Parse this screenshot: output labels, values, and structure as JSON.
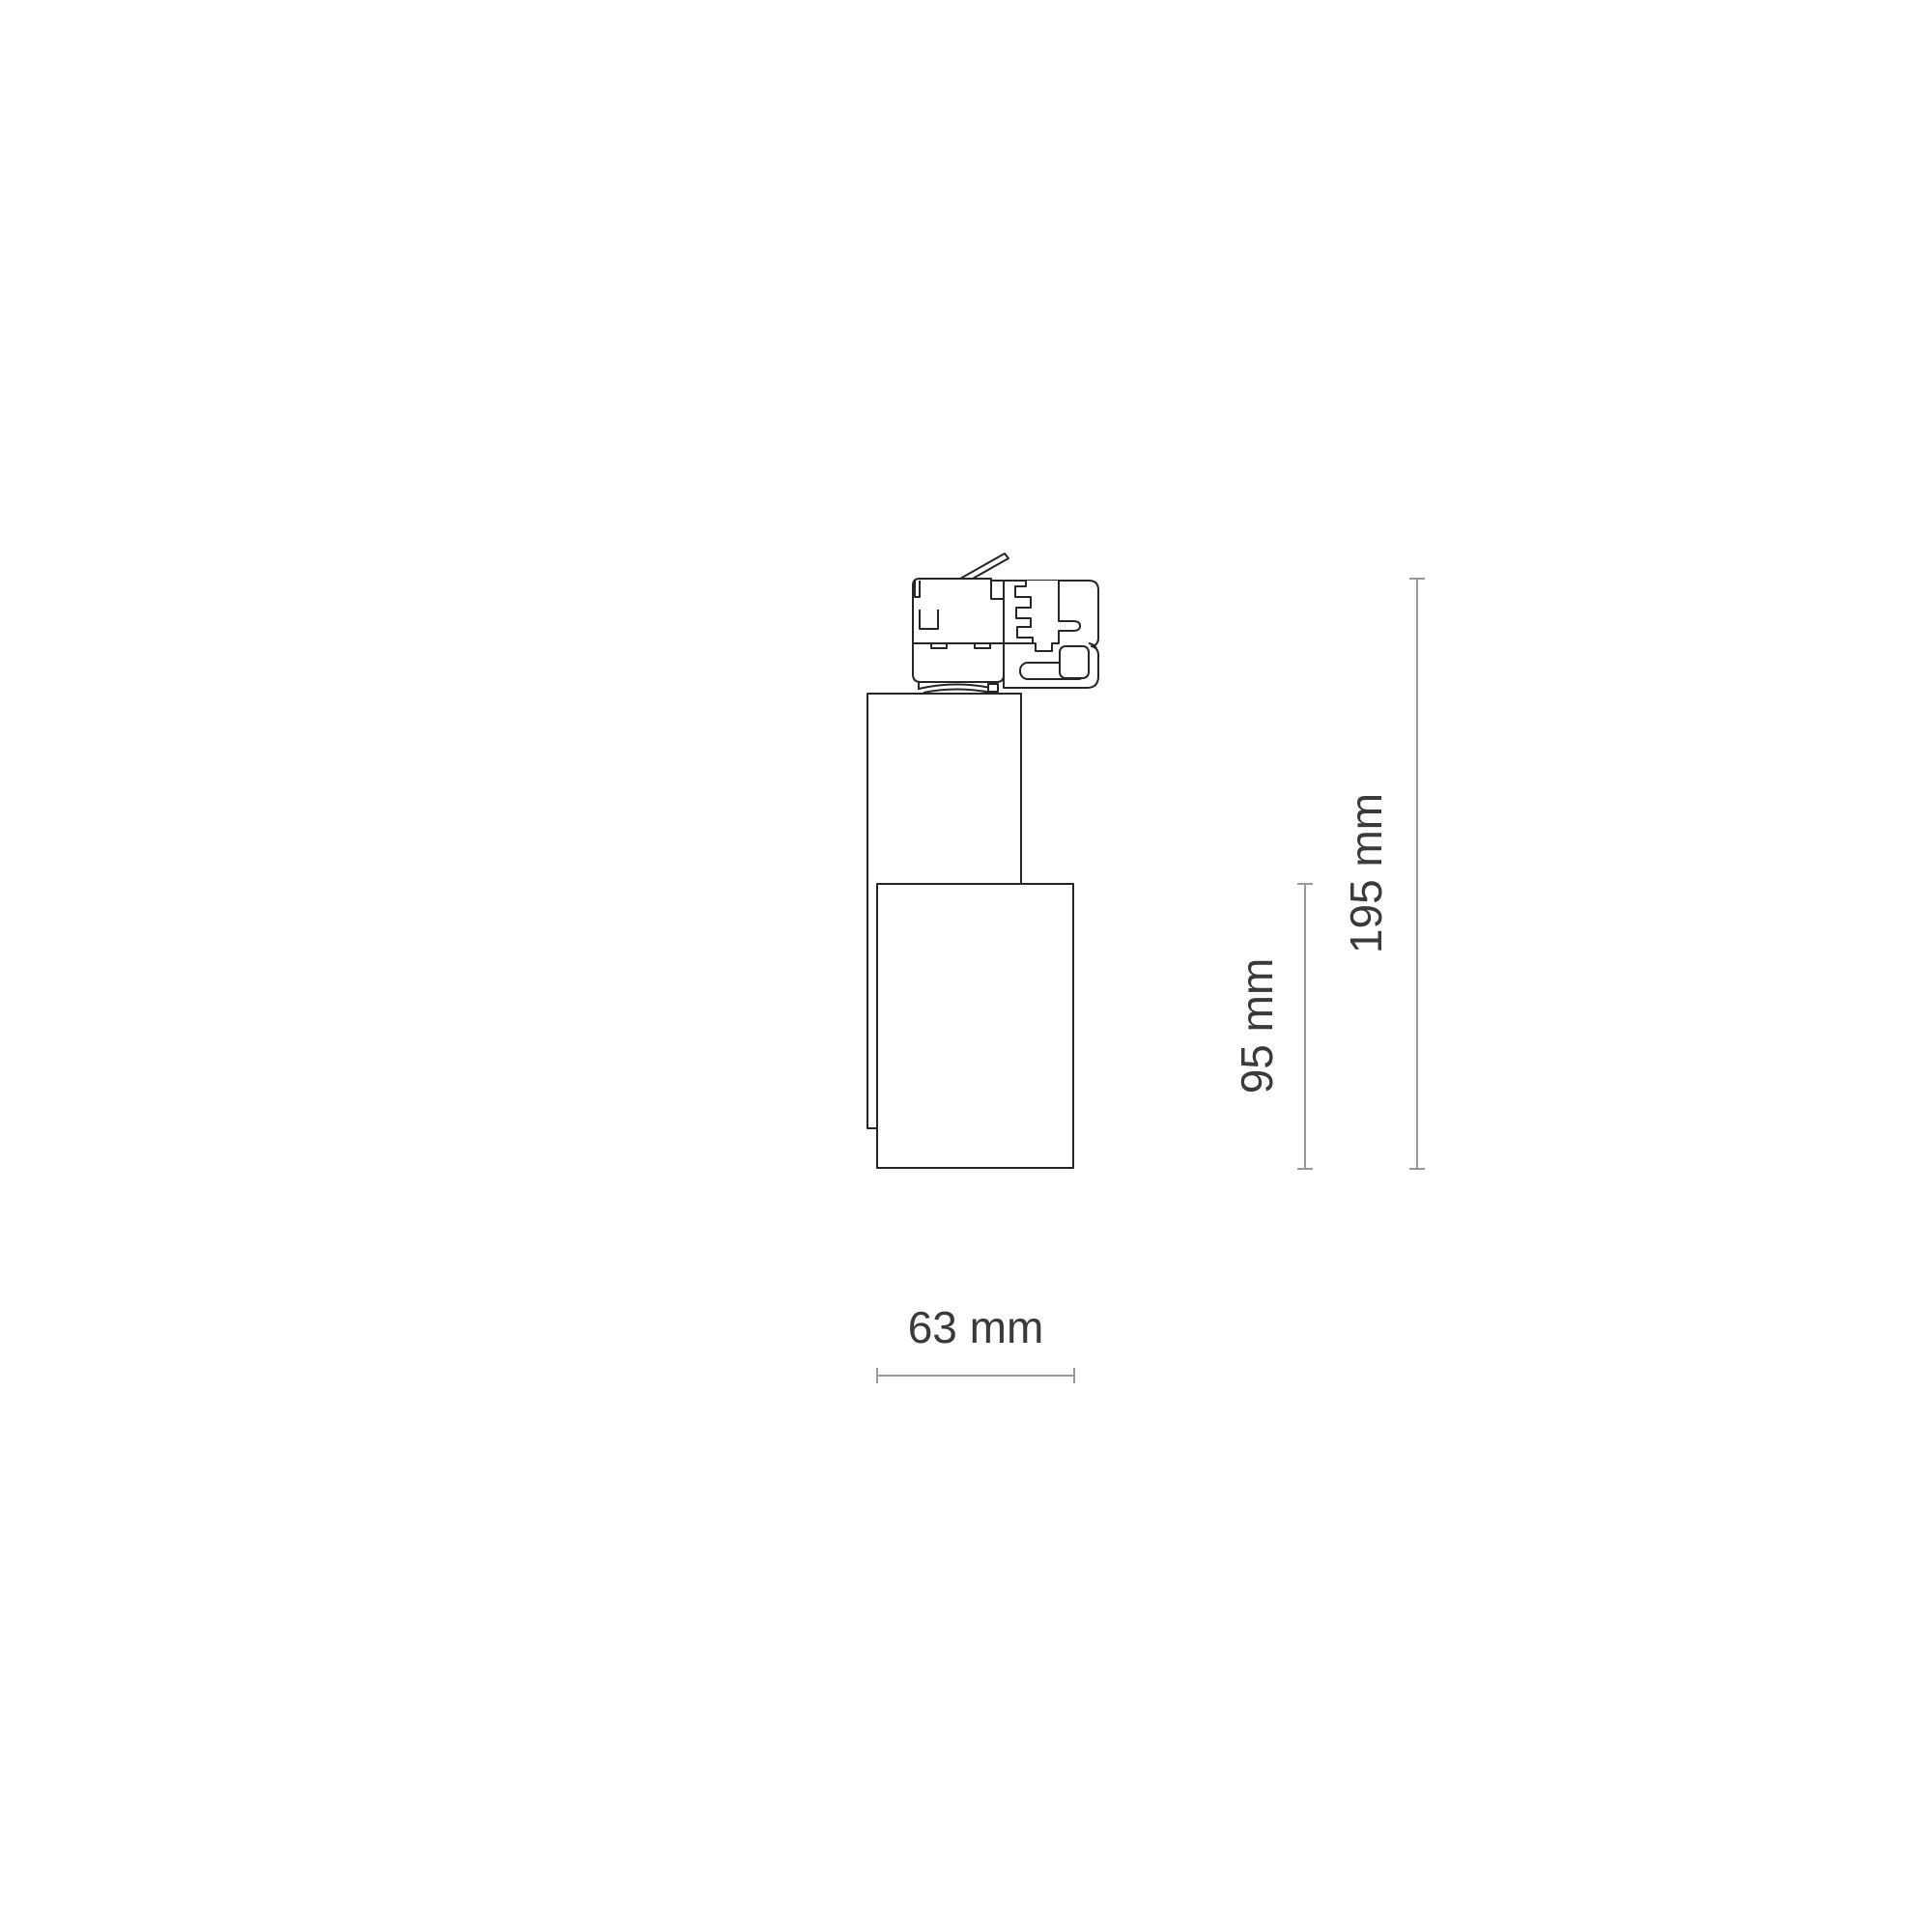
{
  "colors": {
    "background": "#ffffff",
    "drawing_line": "#262626",
    "dimension_line": "#9a9a9a",
    "label_text": "#3a3a3a"
  },
  "diagram": {
    "type": "technical-dimension-drawing",
    "subject": "track-mounted spotlight, side view with track adapter",
    "dimensions": {
      "total_height": {
        "label": "195 mm",
        "value": 195,
        "unit": "mm",
        "orientation": "vertical"
      },
      "body_height": {
        "label": "95 mm",
        "value": 95,
        "unit": "mm",
        "orientation": "vertical"
      },
      "body_width": {
        "label": "63 mm",
        "value": 63,
        "unit": "mm",
        "orientation": "horizontal"
      }
    }
  }
}
